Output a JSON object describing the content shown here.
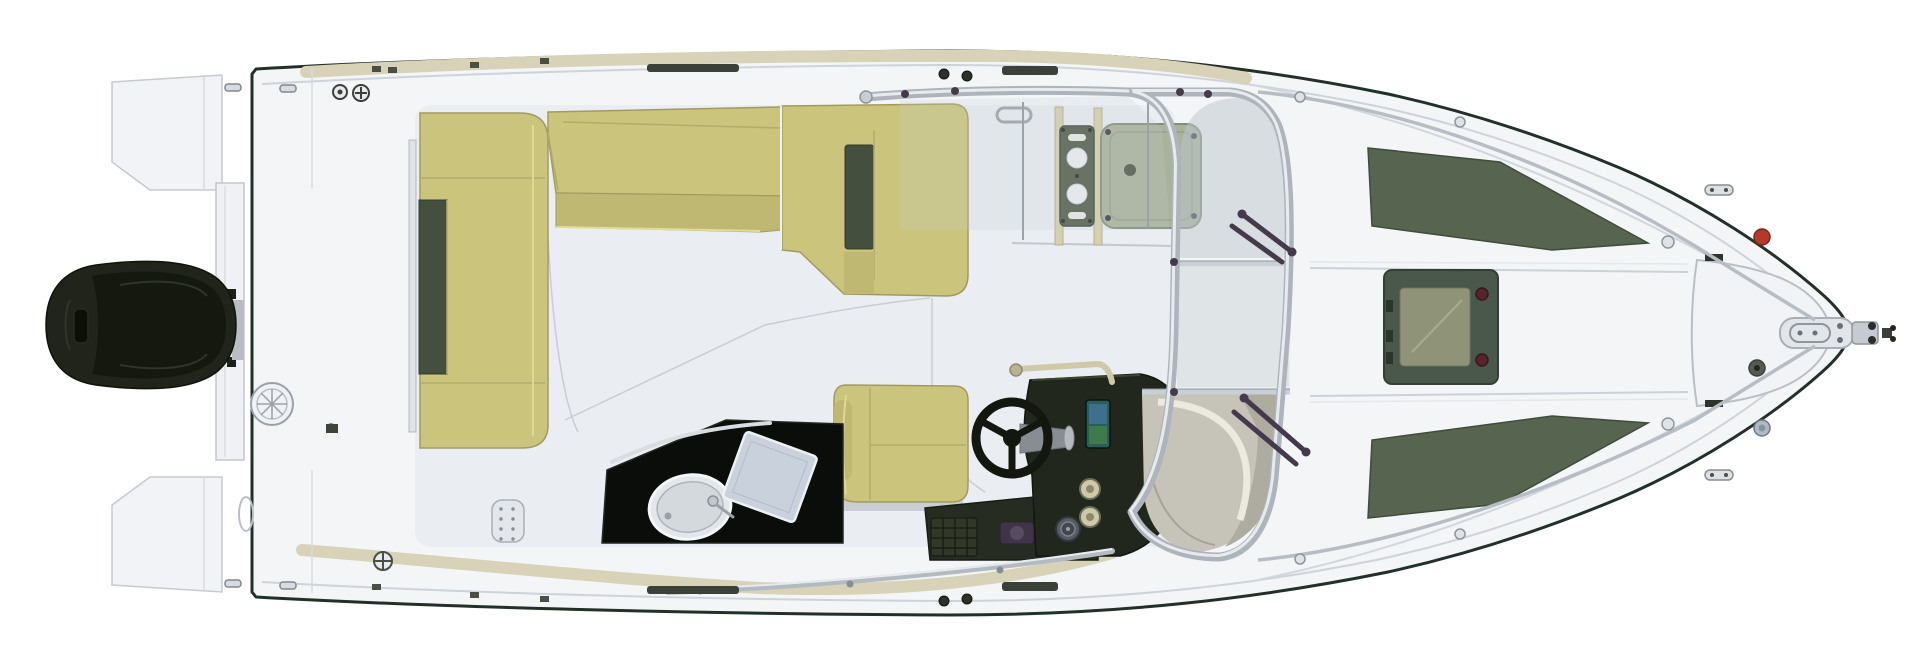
{
  "meta": {
    "type": "boat-deck-plan-top-view",
    "description": "Top-down CAD rendering of an outboard motorboat deck layout, bow pointing right",
    "orientation": "bow-right",
    "background": "#ffffff"
  },
  "colors": {
    "hull_fill": "#f3f5f7",
    "hull_outline": "#233028",
    "deck_line": "#ced3da",
    "gunwale_band": "#d7d2b8",
    "platform": "#f1f3f6",
    "cockpit_floor": "#eaedf1",
    "cushion": "#cbc47c",
    "cushion_shade": "#bfb873",
    "cushion_dark": "#454f3d",
    "seam_khaki": "#b2ab6d",
    "galley_black": "#0b0d0a",
    "sink_fill": "#e3e6ea",
    "stove_fill": "#c9d2dc",
    "console_dark": "#21271c",
    "throttle_fill": "#313827",
    "screen_top": "#3f6f8e",
    "screen_bottom": "#3f7a4a",
    "wheel_dark": "#14170f",
    "hub_gray": "#888d94",
    "engine_dark": "#20241b",
    "engine_inner": "#14180e",
    "frame_silver": "#aeb4bc",
    "frame_highlight": "#e8ebee",
    "rail_silver": "#b7bdc4",
    "glass": "#bcc6cc",
    "glass_light": "#d5dbdf",
    "cabin_base": "#c6c3b8",
    "cabin_shade": "#aeaba0",
    "cabin_light": "#eceadd",
    "pad_green": "#57644f",
    "hatch_frame": "#4a574b",
    "hatch_inner": "#8f9378",
    "sage_hatch": "#a9b39c",
    "speaker_panel": "#4f5a48",
    "hardware_plum": "#453a4c",
    "nav_red": "#b33a2b",
    "nav_gray": "#aebbc4",
    "metal_light": "#e2e6ea",
    "fitting_dark": "#3b4038",
    "tan_post": "#d6d0ae",
    "grab_tan": "#cfc8a9"
  },
  "components": [
    {
      "name": "hull",
      "label": "Hull / deck moulding"
    },
    {
      "name": "outboard-engine",
      "label": "Outboard engine"
    },
    {
      "name": "transom",
      "label": "Transom plate"
    },
    {
      "name": "swim-platform-port",
      "label": "Swim platform (port)"
    },
    {
      "name": "swim-platform-starboard",
      "label": "Swim platform (starboard)"
    },
    {
      "name": "aft-bench",
      "label": "Aft cockpit bench"
    },
    {
      "name": "port-bench",
      "label": "Port L-shaped bench"
    },
    {
      "name": "copilot-seat",
      "label": "Co-pilot / chaise seat"
    },
    {
      "name": "helm-seat",
      "label": "Helm seat"
    },
    {
      "name": "steering-wheel",
      "label": "Steering wheel"
    },
    {
      "name": "helm-console",
      "label": "Helm console with display"
    },
    {
      "name": "wet-bar",
      "label": "Wet bar with sink and stove"
    },
    {
      "name": "windshield",
      "label": "Wrap-around windshield"
    },
    {
      "name": "companionway-hatch",
      "label": "Companionway hatch"
    },
    {
      "name": "dash-speaker-panel",
      "label": "Dash speaker panel"
    },
    {
      "name": "foredeck-sunpad-port",
      "label": "Foredeck pad (port)"
    },
    {
      "name": "foredeck-sunpad-starboard",
      "label": "Foredeck pad (starboard)"
    },
    {
      "name": "foredeck-hatch",
      "label": "Foredeck hatch"
    },
    {
      "name": "anchor-locker",
      "label": "Anchor locker"
    },
    {
      "name": "anchor-windlass",
      "label": "Anchor windlass and roller"
    },
    {
      "name": "navigation-light",
      "label": "Navigation lights"
    },
    {
      "name": "bow-rails",
      "label": "Bow hand rails"
    },
    {
      "name": "deck-fittings",
      "label": "Cleats and deck fittings"
    }
  ]
}
